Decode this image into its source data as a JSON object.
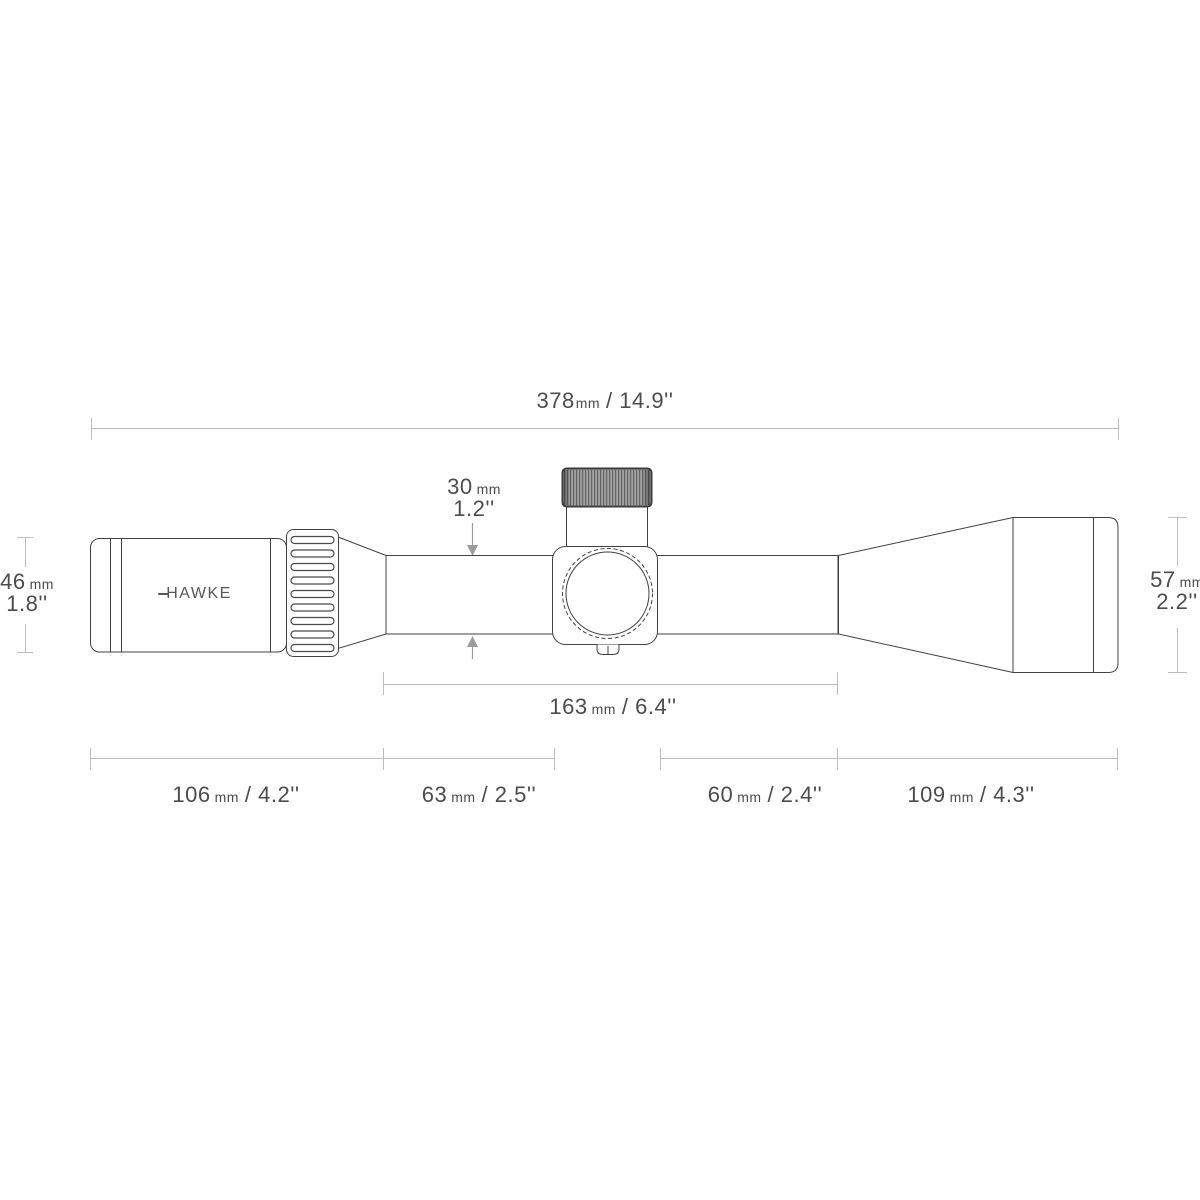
{
  "diagram": {
    "brand": "HAWKE",
    "dimensions": {
      "overall_length": {
        "value": "378",
        "unit": "mm",
        "inches": "/ 14.9''"
      },
      "tube_diameter": {
        "value": "30",
        "unit": "mm",
        "inches": "1.2''"
      },
      "eyepiece_diameter": {
        "value": "46",
        "unit": "mm",
        "inches": "1.8''"
      },
      "objective_diameter": {
        "value": "57",
        "unit": "mm",
        "inches": "2.2''"
      },
      "mid_section_length": {
        "value": "163",
        "unit": "mm",
        "inches": "/ 6.4''"
      },
      "eyepiece_length": {
        "value": "106",
        "unit": "mm",
        "inches": "/ 4.2''"
      },
      "rear_tube_length": {
        "value": "63",
        "unit": "mm",
        "inches": "/ 2.5''"
      },
      "front_tube_length": {
        "value": "60",
        "unit": "mm",
        "inches": "/ 2.4''"
      },
      "objective_length": {
        "value": "109",
        "unit": "mm",
        "inches": "/ 4.3''"
      }
    },
    "colors": {
      "outline": "#414141",
      "dimension_line": "#bcbcbc",
      "arrow": "#9c9c9c",
      "text": "#4c4c4c",
      "turret_cap_fill": "#a2a2a2"
    }
  }
}
